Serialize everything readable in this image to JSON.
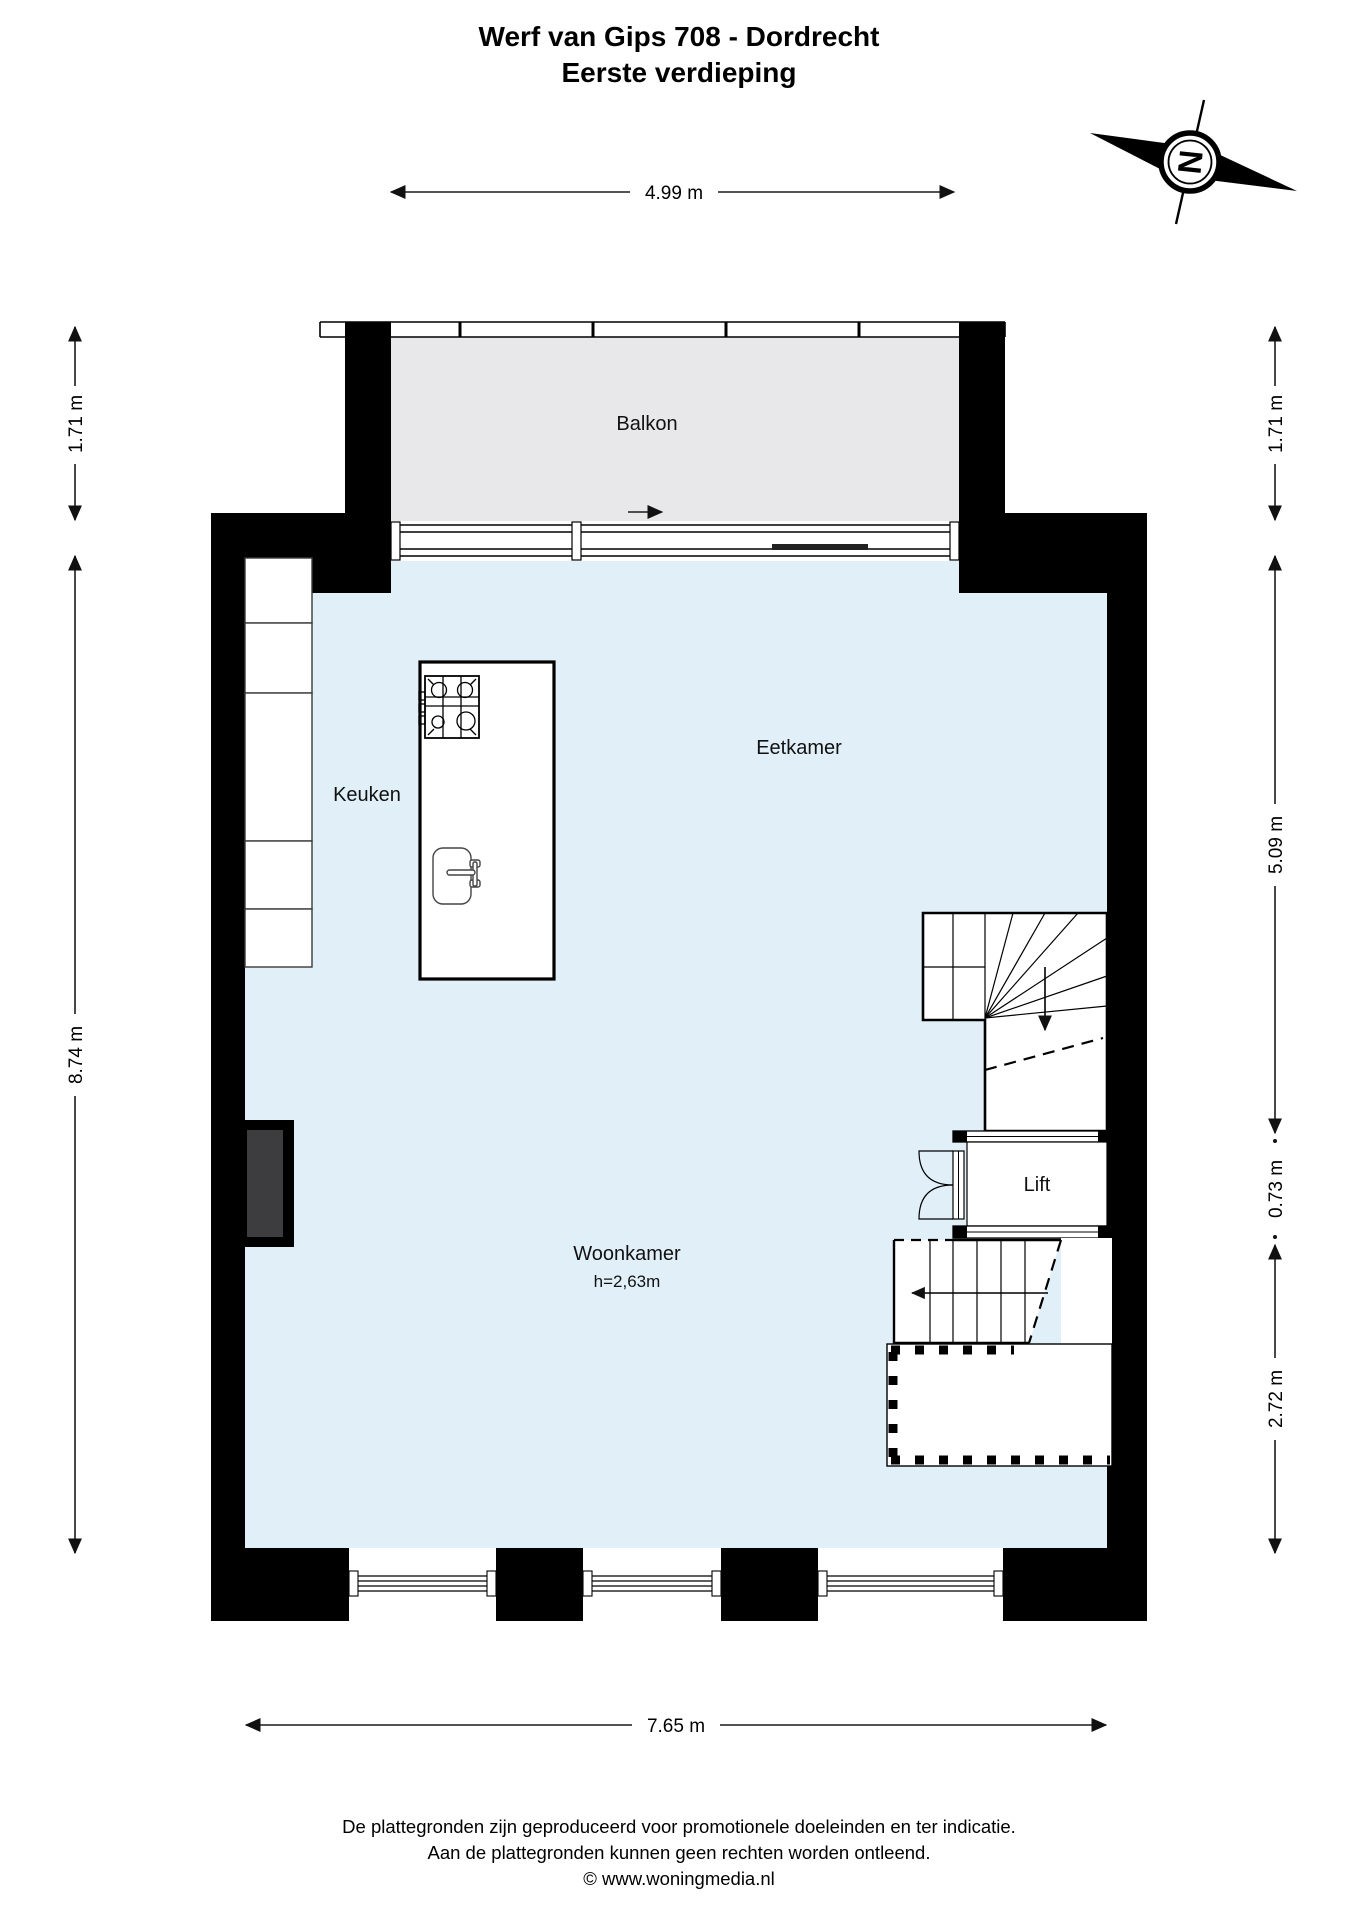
{
  "title": {
    "line1": "Werf van Gips 708 - Dordrecht",
    "line2": "Eerste verdieping"
  },
  "compass": {
    "north_label": "N"
  },
  "dimensions": {
    "top_balcony_width": "4.99 m",
    "left_balcony_depth": "1.71 m",
    "left_main_depth": "8.74 m",
    "right_balcony_depth": "1.71 m",
    "right_upper": "5.09 m",
    "right_lift": "0.73 m",
    "right_lower": "2.72 m",
    "bottom_main_width": "7.65 m"
  },
  "rooms": {
    "balcony": "Balkon",
    "kitchen": "Keuken",
    "dining": "Eetkamer",
    "living": "Woonkamer",
    "living_ceiling_height": "h=2,63m",
    "lift": "Lift"
  },
  "footer": {
    "line1": "De plattegronden zijn geproduceerd voor promotionele doeleinden en ter indicatie.",
    "line2": "Aan de plattegronden kunnen geen rechten worden ontleend.",
    "line3": "© www.woningmedia.nl"
  },
  "colors": {
    "wall": "#000000",
    "interior_floor": "#e1f0f8",
    "balcony_floor": "#e8e8ea",
    "chimney_core": "#3d3d3f"
  }
}
